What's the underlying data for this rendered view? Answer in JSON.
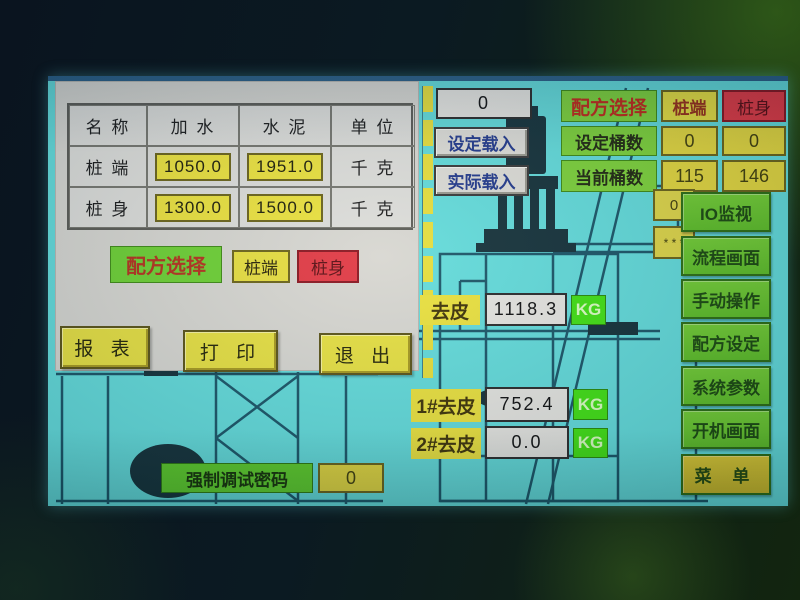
{
  "screen": {
    "recipe_table": {
      "headers": [
        "名 称",
        "加 水",
        "水 泥",
        "单 位"
      ],
      "rows": [
        {
          "name": "桩 端",
          "water": "1050.0",
          "cement": "1951.0",
          "unit": "千 克"
        },
        {
          "name": "桩 身",
          "water": "1300.0",
          "cement": "1500.0",
          "unit": "千 克"
        }
      ]
    },
    "recipe_select_left": {
      "label": "配方选择",
      "pile_end": "桩端",
      "pile_body": "桩身"
    },
    "action_buttons": {
      "report": "报 表",
      "print": "打 印",
      "exit": "退 出"
    },
    "load_panel": {
      "value": "0",
      "set_load": "设定载入",
      "actual_load": "实际载入"
    },
    "recipe_select_right": {
      "label": "配方选择",
      "pile_end": "桩端",
      "pile_body": "桩身"
    },
    "barrel_counts": {
      "set_label": "设定桶数",
      "set_v1": "0",
      "set_v2": "0",
      "current_label": "当前桶数",
      "current_v1": "115",
      "current_v2": "146"
    },
    "tare_main": {
      "label": "去皮",
      "value": "1118.3",
      "unit": "KG"
    },
    "tare_1": {
      "label": "1#去皮",
      "value": "752.4",
      "unit": "KG"
    },
    "tare_2": {
      "label": "2#去皮",
      "value": "0.0",
      "unit": "KG"
    },
    "debug": {
      "label": "强制调试密码",
      "value": "0"
    },
    "partial_boxes": {
      "box1": "0",
      "box2": "* * *"
    },
    "menu": {
      "items": [
        "IO监视",
        "流程画面",
        "手动操作",
        "配方设定",
        "系统参数",
        "开机画面"
      ],
      "menu_button": "菜 单"
    },
    "colors": {
      "screen_bg": "#64dcdb",
      "panel_gray": "#d8d7d1",
      "accent_yellow": "#e8e142",
      "accent_green": "#6ed134",
      "accent_red": "#e23a44",
      "diagram_line": "#1c5668"
    }
  }
}
